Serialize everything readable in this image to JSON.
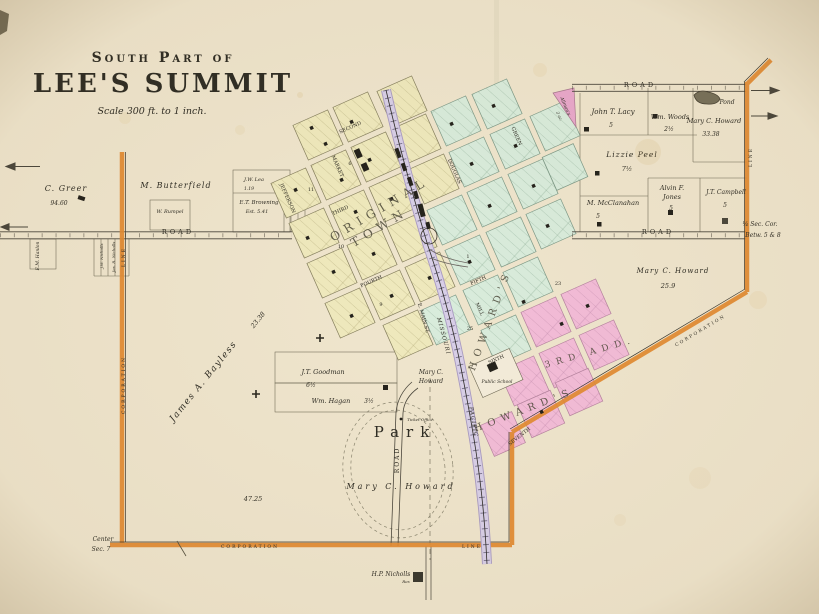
{
  "title": {
    "part1": "South Part of",
    "part2": "LEE'S SUMMIT",
    "scale": "Scale 300 ft. to 1 inch."
  },
  "areas": {
    "original1": "ORIGINAL",
    "original2": "TOWN",
    "howards_green": "HOWARD'S",
    "howards_pink": "HOWARD'S",
    "howards_add": "3RD ADD.",
    "allmans": "Allman's",
    "allmans_ac": "2 ac.",
    "park": "Park"
  },
  "streets": {
    "second": "SECOND",
    "third": "THIRD",
    "fourth": "FOURTH",
    "fifth": "FIFTH",
    "sixth": "SIXTH",
    "seventh": "SEVENTH",
    "market": "MARKET",
    "jefferson": "JEFFERSON",
    "douglas": "DOUGLAS",
    "green": "GREEN",
    "mill": "MILL",
    "emain": "E. MAIN ST."
  },
  "roads": {
    "road": "ROAD"
  },
  "railroad": {
    "name1": "MISSOURI",
    "name2": "PACIFIC"
  },
  "corporation": {
    "corporation": "CORPORATION",
    "line": "LINE"
  },
  "corners": {
    "center": "Center",
    "sec": "Sec. 7",
    "qtr": "¼ Sec. Cor.",
    "betw": "Betw. 5 & 8"
  },
  "landmarks": {
    "school": "Public School",
    "ticket": "Ticket Office",
    "pond": "Pond",
    "res": "Res"
  },
  "owners": {
    "greer": {
      "name": "C. Greer",
      "acres": "94.60"
    },
    "butterfield": {
      "name": "M. Butterfield"
    },
    "rumpel": {
      "name": "W. Rumpel"
    },
    "lea": {
      "name": "J.W. Lea",
      "acres": "1.19"
    },
    "browning": {
      "name": "E.T. Browning",
      "acres": "Est. 5.41"
    },
    "lacy": {
      "name": "John T. Lacy",
      "acres": "5"
    },
    "woods": {
      "name": "Wm. Woods",
      "acres": "2½"
    },
    "howard_ne": {
      "name": "Mary C. Howard",
      "acres": "33.38"
    },
    "peel": {
      "name": "Lizzie Peel",
      "acres": "7½"
    },
    "jones": {
      "name1": "Alvin F.",
      "name2": "Jones",
      "acres": "5"
    },
    "campbell": {
      "name": "J.T. Campbell",
      "acres": "5"
    },
    "mcclanahan": {
      "name": "M. McClanahan",
      "acres": "5"
    },
    "howard_e": {
      "name": "Mary C. Howard",
      "acres": "25.9"
    },
    "bayless": {
      "name": "James A. Bayless",
      "acres": "23.38"
    },
    "goodman": {
      "name": "J.T. Goodman",
      "acres": "6½"
    },
    "hagan": {
      "name": "Wm. Hagan",
      "acres": "3½"
    },
    "howard_mid": {
      "name1": "Mary C.",
      "name2": "Howard"
    },
    "howard_park": {
      "name": "Mary C. Howard",
      "acres": "47.25"
    },
    "nicholls_hp": {
      "name": "H.P. Nicholls"
    },
    "hanlon": {
      "name": "E.M. Hanlon"
    },
    "nicholls_jw": {
      "name": "J.W. Nicholls"
    },
    "nicholls_jr": {
      "name": "Jas. R. Nicholls"
    }
  },
  "block_numbers": [
    {
      "v": "11"
    },
    {
      "v": "6"
    },
    {
      "v": "10"
    },
    {
      "v": "9"
    },
    {
      "v": "1"
    },
    {
      "v": "23"
    },
    {
      "v": "25"
    }
  ],
  "colors": {
    "paper": "#efe5cd",
    "block_yellow": "#efe9bd",
    "block_green": "#d9ecdc",
    "block_pink": "#f3bcd8",
    "railroad": "#d8cfe8",
    "corporation_line": "#e28a31",
    "ink": "#2e2c24"
  }
}
